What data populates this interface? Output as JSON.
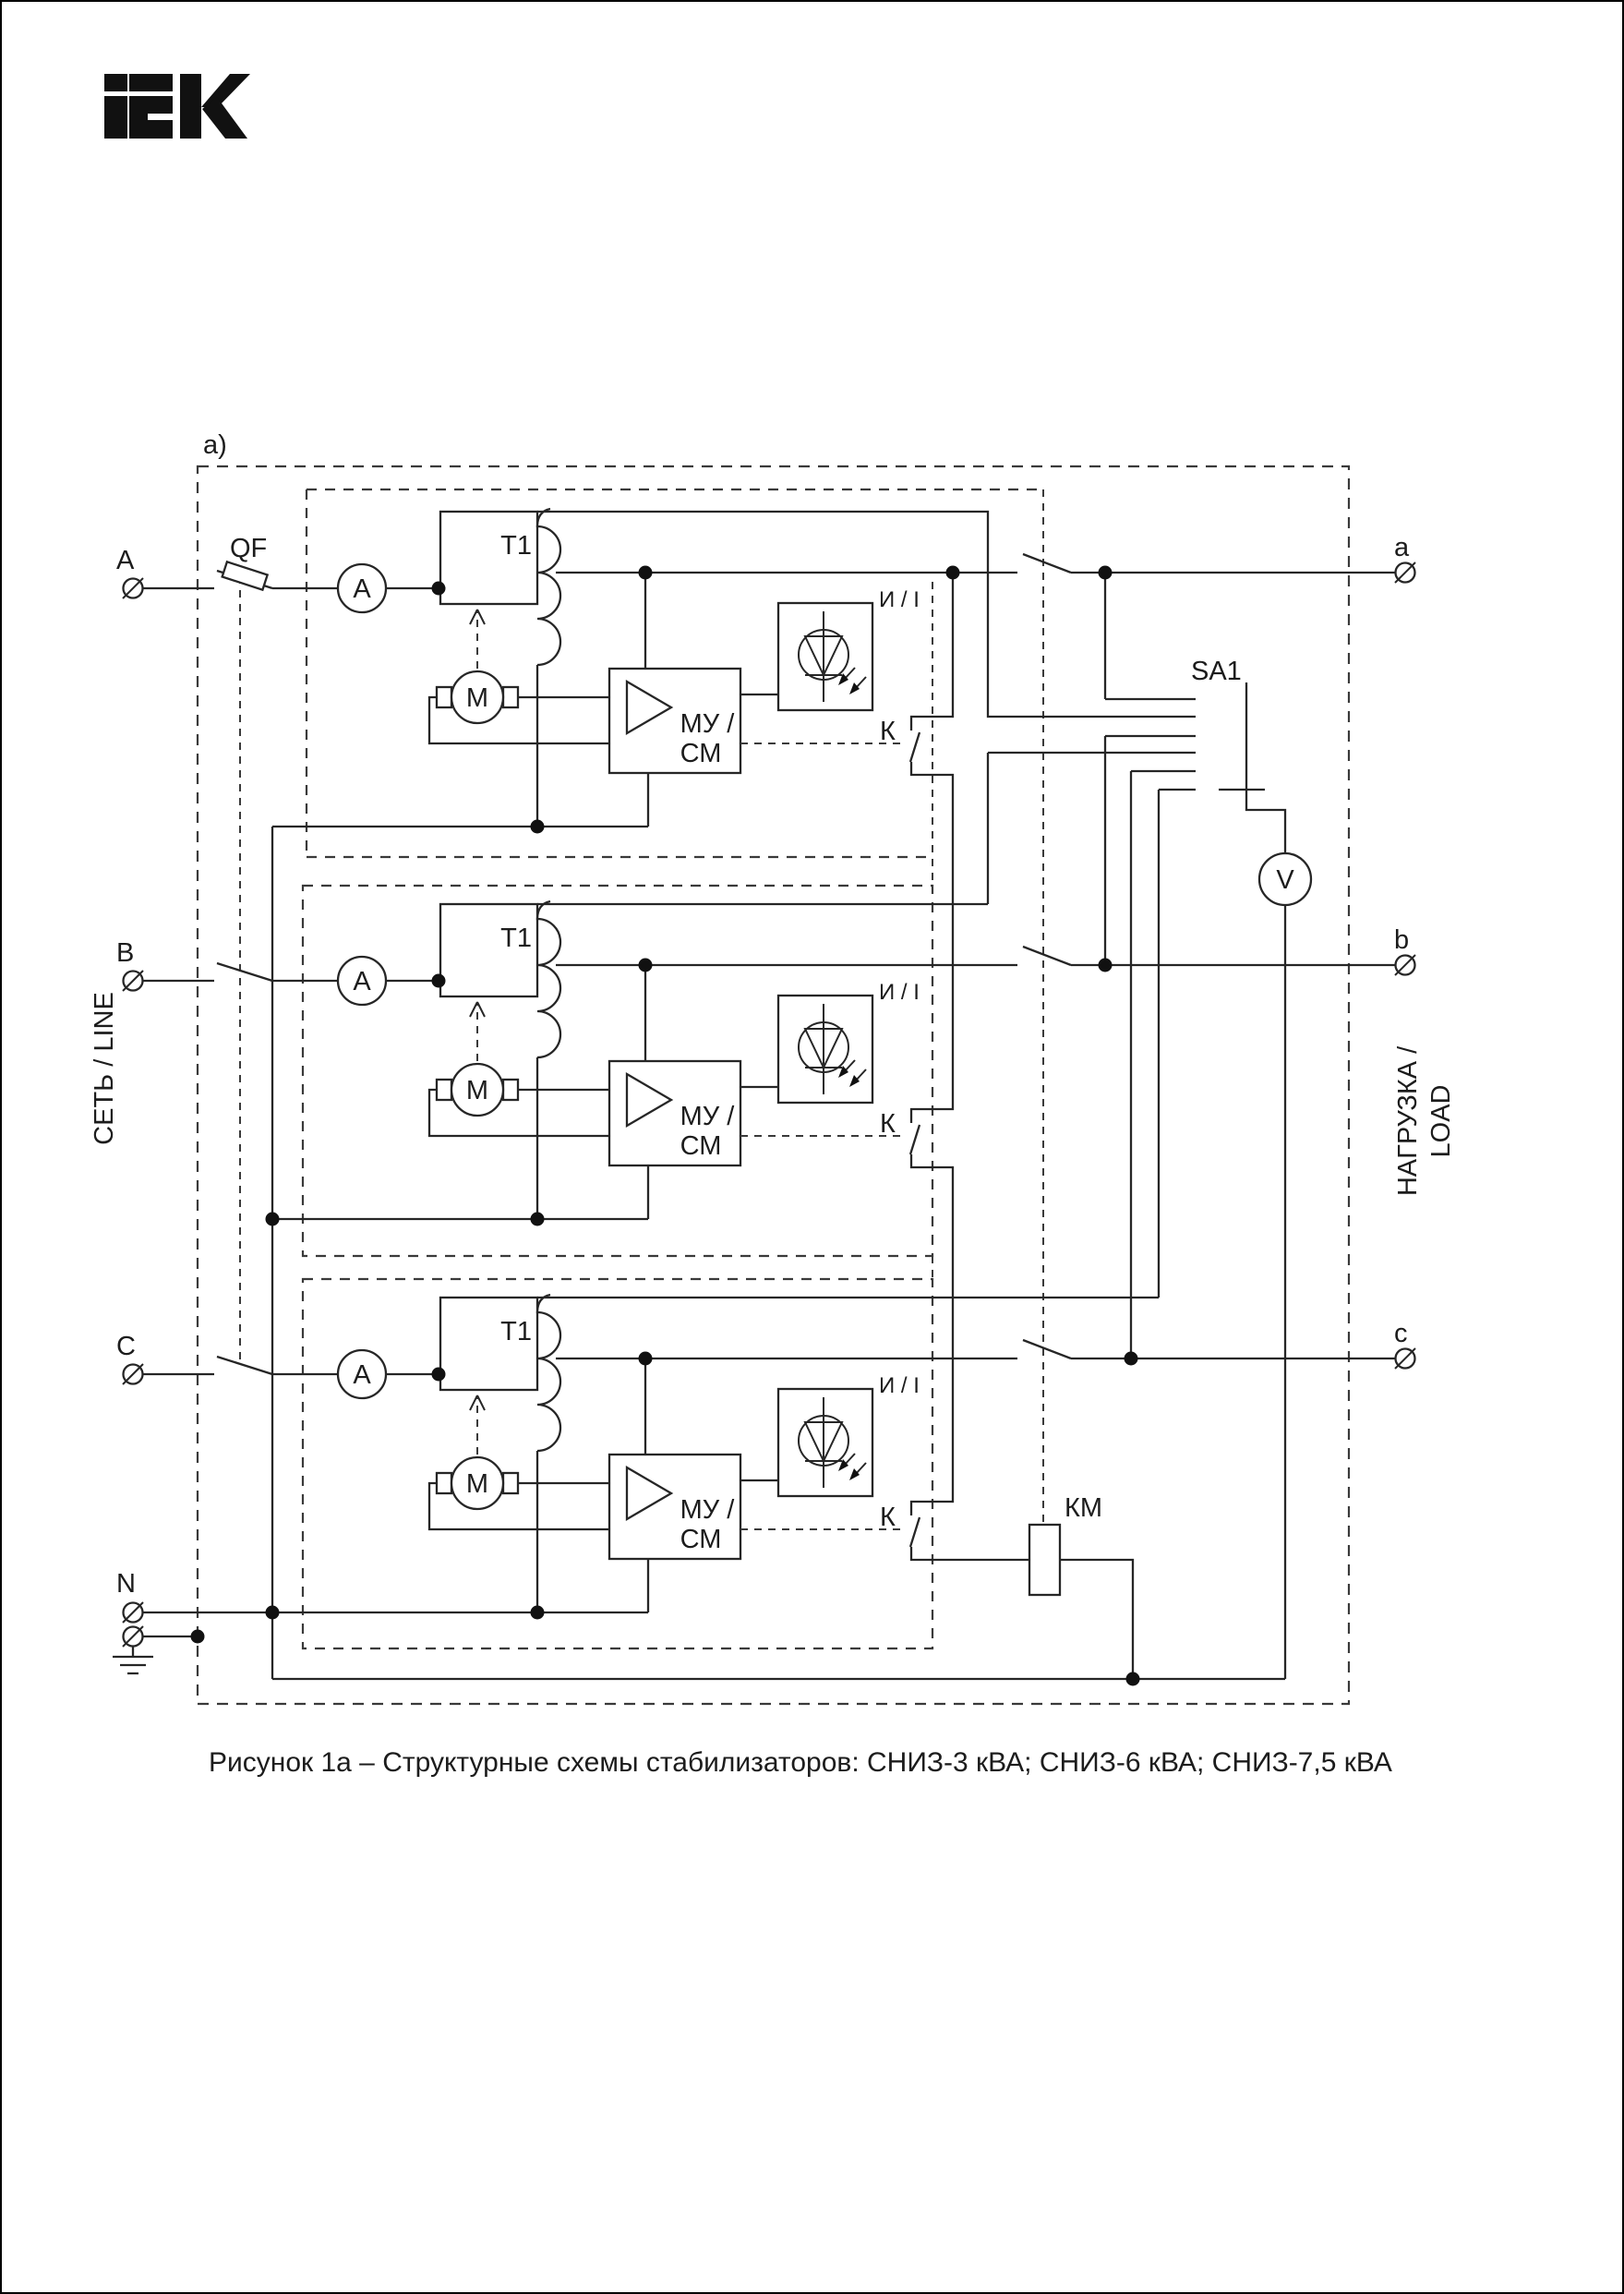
{
  "page": {
    "brand": "IEK",
    "figure_marker": "а)",
    "caption": "Рисунок 1а – Структурные схемы стабилизаторов: СНИЗ-3 кВА; СНИЗ-6 кВА; СНИЗ-7,5 кВА"
  },
  "colors": {
    "ink": "#1c1c1c",
    "paper": "#ffffff"
  },
  "terminals": {
    "input": [
      {
        "label": "А"
      },
      {
        "label": "В"
      },
      {
        "label": "С"
      },
      {
        "label": "N"
      }
    ],
    "output": [
      {
        "label": "a"
      },
      {
        "label": "b"
      },
      {
        "label": "c"
      }
    ]
  },
  "components": {
    "breaker": "QF",
    "selector": "SA1",
    "voltmeter": "V",
    "contactor": "КМ",
    "transformer": "T1",
    "ammeter": "А",
    "motor": "М",
    "amplifier_line1": "МУ /",
    "amplifier_line2": "СМ",
    "indicator": "И / I",
    "relay_contact": "К"
  },
  "side_labels": {
    "left": "СЕТЬ / LINE",
    "right_line1": "НАГРУЗКА /",
    "right_line2": "LOAD"
  }
}
